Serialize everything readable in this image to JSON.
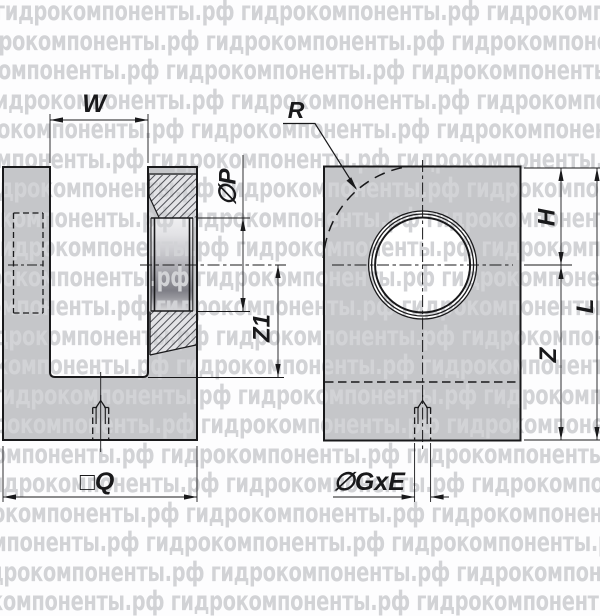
{
  "drawing": {
    "watermark_text": "гидрокомпоненты.рф",
    "dimension_labels": {
      "w": "W",
      "p": "∅P",
      "z1": "Z1",
      "q": "□Q",
      "r": "R",
      "h": "H",
      "z": "Z",
      "l": "L",
      "gxe": "∅GxE"
    },
    "colors": {
      "body_fill": "#c5c6c9",
      "hatch_fill": "#e3e3e6",
      "line": "#19191b",
      "watermark": "#d2d3d6",
      "background": "#fdfdfe"
    }
  }
}
